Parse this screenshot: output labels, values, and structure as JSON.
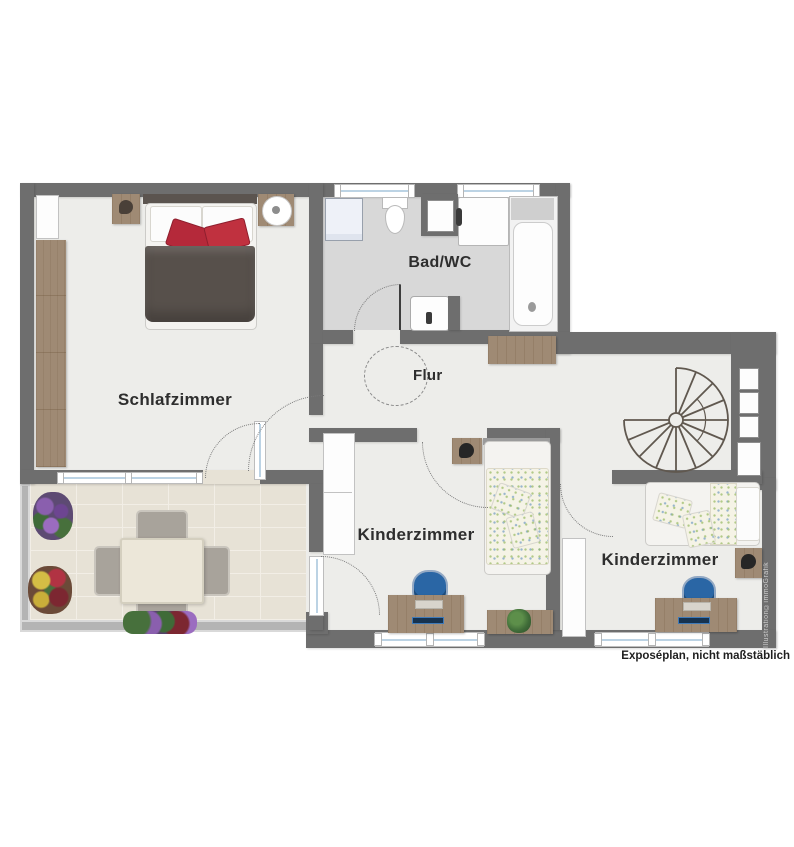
{
  "plan": {
    "rooms": [
      {
        "id": "schlafzimmer",
        "label": "Schlafzimmer"
      },
      {
        "id": "bad_wc",
        "label": "Bad/WC"
      },
      {
        "id": "flur",
        "label": "Flur"
      },
      {
        "id": "kinderzimmer_1",
        "label": "Kinderzimmer"
      },
      {
        "id": "kinderzimmer_2",
        "label": "Kinderzimmer"
      }
    ],
    "notes": {
      "disclaimer": "Exposéplan, nicht maßstäblich",
      "watermark": "Illustration©immoGrafik"
    },
    "colors": {
      "wall": "#6e6e6e",
      "floor": "#ededea",
      "bath_tile": "#d8d8d8",
      "terrace_tile": "#e7e2d6",
      "wood": "#9f8a74",
      "duvet": "#57504b",
      "accent_pillow": "#b5293a",
      "desk_chair": "#2a66a5",
      "glass": "#bcd3e4",
      "railing": "#b4b4b4",
      "plant": "#3f6b38"
    }
  }
}
